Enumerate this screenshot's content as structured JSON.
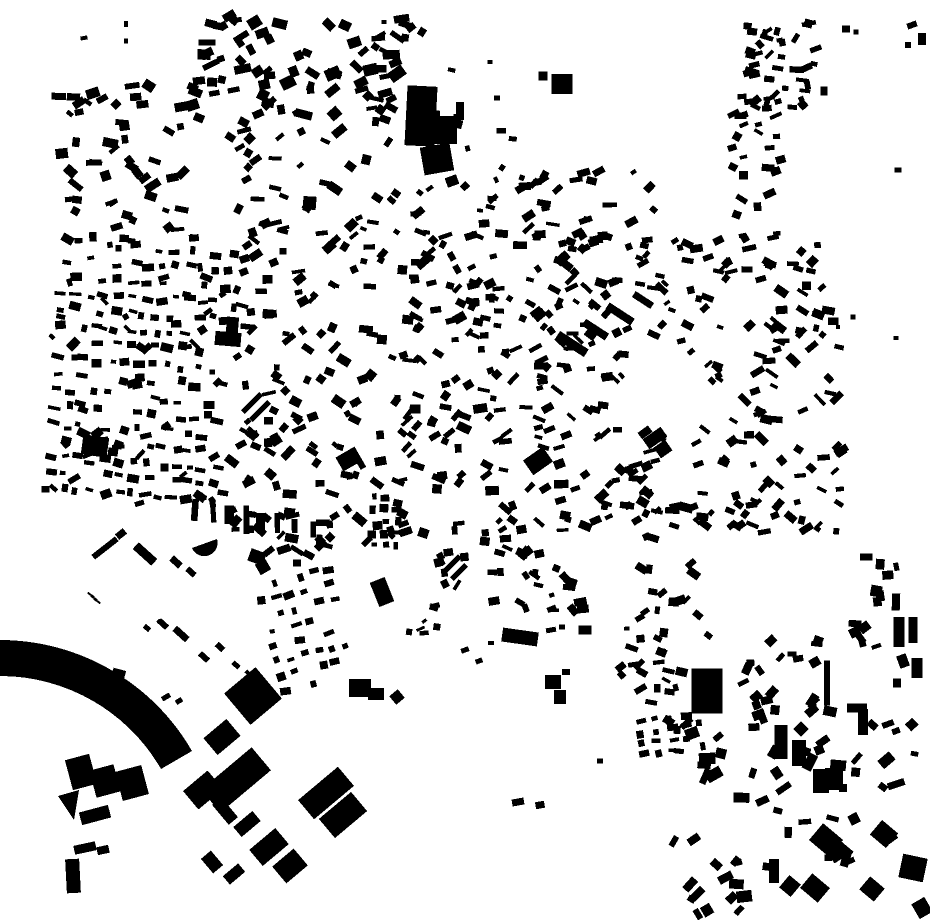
{
  "canvas": {
    "width": 930,
    "height": 924,
    "background": "#ffffff",
    "building_color": "#000000"
  },
  "map": {
    "kind": "figure-ground-building-footprints",
    "holes": [
      {
        "cx": 672,
        "cy": 392,
        "rx": 40,
        "ry": 45
      }
    ],
    "paths": [
      "M0,640 A222,222 0 0 1 192,751 L161,769 A186,186 0 0 0 0,676 Z",
      "M192,548 L217,539 A13.3,13.3 0 0 1 192,548 Z",
      "M58,796 L79,790 L74,820 Z"
    ],
    "landmark_rects": [
      [
        421,
        116,
        30,
        60,
        3
      ],
      [
        442,
        130,
        30,
        28,
        0
      ],
      [
        437,
        159,
        30,
        28,
        -10
      ],
      [
        460,
        111,
        8,
        18,
        0
      ],
      [
        452,
        181,
        12,
        10,
        -20
      ],
      [
        543,
        76,
        9,
        9,
        0
      ],
      [
        562,
        84,
        21,
        20,
        0
      ],
      [
        228,
        339,
        26,
        14,
        5
      ],
      [
        232,
        330,
        12,
        26,
        5
      ],
      [
        95,
        446,
        26,
        20,
        8
      ],
      [
        113,
        452,
        10,
        8,
        8
      ],
      [
        349,
        459,
        22,
        16,
        -30
      ],
      [
        538,
        461,
        24,
        18,
        -35
      ],
      [
        382,
        592,
        16,
        26,
        -22
      ],
      [
        252,
        403,
        26,
        5,
        -45
      ],
      [
        260,
        411,
        26,
        5,
        -45
      ],
      [
        452,
        564,
        22,
        5,
        -45
      ],
      [
        459,
        572,
        20,
        5,
        -45
      ],
      [
        572,
        344,
        34,
        9,
        33
      ],
      [
        596,
        330,
        26,
        8,
        33
      ],
      [
        620,
        314,
        30,
        8,
        33
      ],
      [
        643,
        300,
        22,
        7,
        33
      ],
      [
        655,
        438,
        22,
        12,
        -35
      ],
      [
        663,
        449,
        14,
        13,
        -35
      ],
      [
        520,
        637,
        36,
        14,
        8
      ],
      [
        553,
        682,
        16,
        14,
        0
      ],
      [
        560,
        697,
        12,
        14,
        0
      ],
      [
        566,
        672,
        8,
        6,
        0
      ],
      [
        585,
        630,
        13,
        9,
        0
      ],
      [
        551,
        630,
        10,
        5,
        -10
      ],
      [
        562,
        627,
        6,
        5,
        0
      ],
      [
        600,
        761,
        6,
        5,
        0
      ],
      [
        518,
        802,
        12,
        7,
        -10
      ],
      [
        540,
        805,
        9,
        7,
        -10
      ],
      [
        297,
        563,
        8,
        7,
        0
      ],
      [
        257,
        557,
        16,
        13,
        20
      ],
      [
        263,
        567,
        12,
        12,
        -30
      ],
      [
        707,
        691,
        31,
        45,
        0
      ],
      [
        821,
        781,
        16,
        24,
        0
      ],
      [
        834,
        779,
        18,
        22,
        0
      ],
      [
        843,
        788,
        8,
        8,
        0
      ],
      [
        857,
        708,
        20,
        9,
        0
      ],
      [
        863,
        722,
        10,
        26,
        0
      ],
      [
        888,
        724,
        12,
        6,
        -20
      ],
      [
        896,
        731,
        8,
        6,
        -20
      ],
      [
        781,
        742,
        13,
        34,
        0
      ],
      [
        799,
        753,
        14,
        26,
        0
      ],
      [
        801,
        729,
        11,
        11,
        45
      ],
      [
        827,
        683,
        6,
        45,
        0
      ],
      [
        884,
        834,
        21,
        19,
        40
      ],
      [
        826,
        840,
        26,
        22,
        40
      ],
      [
        843,
        852,
        16,
        14,
        40
      ],
      [
        913,
        868,
        25,
        24,
        12
      ],
      [
        922,
        908,
        15,
        17,
        -30
      ],
      [
        872,
        889,
        19,
        17,
        40
      ],
      [
        815,
        888,
        23,
        19,
        40
      ],
      [
        774,
        871,
        10,
        24,
        0
      ],
      [
        790,
        886,
        15,
        16,
        40
      ],
      [
        899,
        632,
        11,
        30,
        0
      ],
      [
        913,
        630,
        9,
        26,
        0
      ],
      [
        903,
        661,
        10,
        13,
        -20
      ],
      [
        917,
        668,
        11,
        20,
        0
      ],
      [
        897,
        683,
        8,
        9,
        0
      ],
      [
        81,
        772,
        25,
        31,
        -15
      ],
      [
        105,
        781,
        25,
        28,
        -15
      ],
      [
        132,
        783,
        27,
        30,
        -15
      ],
      [
        95,
        815,
        30,
        13,
        -15
      ],
      [
        85,
        848,
        22,
        9,
        -12
      ],
      [
        103,
        850,
        12,
        8,
        -12
      ],
      [
        73,
        876,
        14,
        34,
        -3
      ],
      [
        253,
        696,
        41,
        41,
        -40
      ],
      [
        222,
        737,
        30,
        22,
        -40
      ],
      [
        236,
        780,
        66,
        30,
        -40
      ],
      [
        203,
        790,
        32,
        24,
        -40
      ],
      [
        225,
        811,
        12,
        26,
        -40
      ],
      [
        247,
        824,
        25,
        13,
        -40
      ],
      [
        269,
        847,
        34,
        21,
        -40
      ],
      [
        290,
        866,
        28,
        22,
        -40
      ],
      [
        212,
        862,
        13,
        19,
        -40
      ],
      [
        234,
        874,
        20,
        11,
        -40
      ],
      [
        326,
        793,
        52,
        25,
        -40
      ],
      [
        343,
        815,
        42,
        25,
        -40
      ],
      [
        397,
        697,
        11,
        11,
        -40
      ],
      [
        360,
        688,
        22,
        18,
        0
      ],
      [
        376,
        694,
        16,
        12,
        0
      ],
      [
        117,
        680,
        13,
        22,
        15
      ],
      [
        166,
        697,
        9,
        5,
        -30
      ],
      [
        179,
        701,
        7,
        5,
        -30
      ],
      [
        147,
        628,
        7,
        5,
        40
      ],
      [
        160,
        622,
        6,
        4,
        40
      ],
      [
        163,
        624,
        11,
        6,
        42
      ],
      [
        181,
        634,
        17,
        7,
        42
      ],
      [
        204,
        657,
        11,
        6,
        42
      ],
      [
        220,
        647,
        9,
        6,
        42
      ],
      [
        236,
        665,
        8,
        5,
        42
      ],
      [
        248,
        673,
        6,
        4,
        42
      ],
      [
        105,
        548,
        30,
        6,
        -38
      ],
      [
        121,
        534,
        10,
        7,
        -38
      ],
      [
        145,
        554,
        25,
        9,
        42
      ],
      [
        176,
        562,
        12,
        7,
        42
      ],
      [
        191,
        572,
        10,
        6,
        42
      ],
      [
        91,
        595,
        8,
        2,
        35
      ],
      [
        94,
        598,
        8,
        2,
        35
      ],
      [
        97,
        601,
        8,
        2,
        35
      ],
      [
        84,
        38,
        7,
        4,
        -10
      ],
      [
        126,
        24,
        4,
        6,
        0
      ],
      [
        126,
        41,
        4,
        5,
        0
      ],
      [
        384,
        22,
        5,
        4,
        0
      ],
      [
        397,
        61,
        6,
        5,
        -20
      ],
      [
        490,
        62,
        5,
        4,
        0
      ],
      [
        497,
        98,
        6,
        5,
        0
      ],
      [
        912,
        25,
        10,
        6,
        -20
      ],
      [
        922,
        39,
        8,
        12,
        0
      ],
      [
        908,
        45,
        6,
        6,
        0
      ],
      [
        846,
        29,
        8,
        7,
        0
      ],
      [
        856,
        32,
        5,
        5,
        0
      ],
      [
        824,
        91,
        7,
        9,
        0
      ],
      [
        898,
        170,
        7,
        5,
        0
      ],
      [
        853,
        317,
        5,
        5,
        0
      ],
      [
        896,
        338,
        5,
        4,
        0
      ],
      [
        838,
        327,
        4,
        4,
        0
      ],
      [
        465,
        650,
        8,
        5,
        -20
      ],
      [
        479,
        661,
        7,
        5,
        -20
      ],
      [
        491,
        643,
        6,
        4,
        0
      ]
    ],
    "generators": [
      {
        "m": "s",
        "x": 130,
        "y": 162,
        "w": 150,
        "h": 155,
        "n": 55,
        "bw": 11,
        "bh": 7,
        "a": 0,
        "aj": 45,
        "s": 11
      },
      {
        "m": "s",
        "x": 300,
        "y": 70,
        "w": 215,
        "h": 112,
        "n": 72,
        "bw": 12,
        "bh": 8,
        "a": 0,
        "aj": 45,
        "s": 12
      },
      {
        "m": "s",
        "x": 292,
        "y": 180,
        "w": 125,
        "h": 105,
        "n": 30,
        "bw": 11,
        "bh": 7,
        "a": 0,
        "aj": 45,
        "s": 13
      },
      {
        "m": "s",
        "x": 398,
        "y": 112,
        "w": 130,
        "h": 175,
        "n": 26,
        "bw": 10,
        "bh": 7,
        "a": 0,
        "aj": 45,
        "s": 14
      },
      {
        "m": "g",
        "x": 140,
        "y": 372,
        "rows": 16,
        "cols": 13,
        "sx": 13.8,
        "sy": 16.5,
        "rot": 4,
        "bw": 9,
        "bh": 6,
        "aj": 14,
        "skip": 0.28,
        "jit": 3.5,
        "s": 15
      },
      {
        "m": "s",
        "x": 140,
        "y": 372,
        "w": 180,
        "h": 265,
        "n": 45,
        "bw": 9,
        "bh": 6,
        "a": 0,
        "aj": 50,
        "s": 16
      },
      {
        "m": "s",
        "x": 398,
        "y": 390,
        "w": 335,
        "h": 330,
        "n": 300,
        "bw": 10,
        "bh": 6.5,
        "a": -5,
        "aj": 50,
        "s": 17
      },
      {
        "m": "s",
        "x": 700,
        "y": 388,
        "w": 285,
        "h": 300,
        "n": 250,
        "bw": 10,
        "bh": 6,
        "a": 0,
        "aj": 50,
        "s": 18
      },
      {
        "m": "s",
        "x": 782,
        "y": 66,
        "w": 72,
        "h": 85,
        "n": 40,
        "bw": 10,
        "bh": 6,
        "a": -20,
        "aj": 40,
        "s": 19
      },
      {
        "m": "s",
        "x": 757,
        "y": 165,
        "w": 50,
        "h": 150,
        "n": 30,
        "bw": 9,
        "bh": 6,
        "a": 0,
        "aj": 35,
        "s": 20
      },
      {
        "m": "s",
        "x": 560,
        "y": 213,
        "w": 215,
        "h": 88,
        "n": 46,
        "bw": 10,
        "bh": 6,
        "a": -10,
        "aj": 40,
        "s": 21
      },
      {
        "m": "r",
        "x1": 196,
        "y1": 511,
        "x2": 312,
        "y2": 529,
        "n": 8,
        "bw": 9,
        "bh": 25,
        "a": 0,
        "skip": 0,
        "jit": 2,
        "s": 22
      },
      {
        "m": "g",
        "x": 306,
        "y": 630,
        "rows": 8,
        "cols": 6,
        "sx": 14,
        "sy": 15.5,
        "rot": -14,
        "bw": 8,
        "bh": 6,
        "aj": 8,
        "skip": 0.16,
        "jit": 2,
        "s": 23
      },
      {
        "m": "g",
        "x": 385,
        "y": 521,
        "rows": 5,
        "cols": 3,
        "sx": 12,
        "sy": 12,
        "rot": 0,
        "bw": 7,
        "bh": 6,
        "aj": 6,
        "skip": 0.1,
        "jit": 1.5,
        "s": 24
      },
      {
        "m": "g",
        "x": 672,
        "y": 734,
        "rows": 4,
        "cols": 5,
        "sx": 15,
        "sy": 11.5,
        "rot": -8,
        "bw": 8,
        "bh": 6,
        "aj": 8,
        "skip": 0.15,
        "jit": 2,
        "s": 25
      },
      {
        "m": "s",
        "x": 665,
        "y": 640,
        "w": 95,
        "h": 165,
        "n": 32,
        "bw": 9,
        "bh": 6,
        "a": 0,
        "aj": 45,
        "s": 26
      },
      {
        "m": "r",
        "x1": 652,
        "y1": 572,
        "x2": 680,
        "y2": 752,
        "n": 10,
        "bw": 9,
        "bh": 7,
        "a": 10,
        "skip": 0.1,
        "jit": 3,
        "s": 27
      },
      {
        "m": "s",
        "x": 778,
        "y": 676,
        "w": 85,
        "h": 80,
        "n": 20,
        "bw": 10,
        "bh": 7,
        "a": -30,
        "aj": 40,
        "s": 28
      },
      {
        "m": "s",
        "x": 792,
        "y": 798,
        "w": 255,
        "h": 175,
        "n": 48,
        "bw": 12,
        "bh": 8,
        "a": -30,
        "aj": 45,
        "s": 29
      },
      {
        "m": "s",
        "x": 712,
        "y": 888,
        "w": 75,
        "h": 60,
        "n": 10,
        "bw": 11,
        "bh": 8,
        "a": -20,
        "aj": 40,
        "s": 30
      },
      {
        "m": "s",
        "x": 537,
        "y": 585,
        "w": 95,
        "h": 75,
        "n": 22,
        "bw": 9,
        "bh": 6,
        "a": 10,
        "aj": 45,
        "s": 31
      },
      {
        "m": "s",
        "x": 450,
        "y": 572,
        "w": 45,
        "h": 40,
        "n": 8,
        "bw": 9,
        "bh": 6,
        "a": -30,
        "aj": 30,
        "s": 32
      },
      {
        "m": "s",
        "x": 418,
        "y": 618,
        "w": 50,
        "h": 45,
        "n": 7,
        "bw": 8,
        "bh": 5,
        "a": -20,
        "aj": 40,
        "s": 33
      },
      {
        "m": "s",
        "x": 877,
        "y": 578,
        "w": 40,
        "h": 55,
        "n": 8,
        "bw": 9,
        "bh": 12,
        "a": 0,
        "aj": 12,
        "s": 34
      },
      {
        "m": "s",
        "x": 872,
        "y": 632,
        "w": 35,
        "h": 40,
        "n": 6,
        "bw": 9,
        "bh": 7,
        "a": -20,
        "aj": 30,
        "s": 35
      },
      {
        "m": "s",
        "x": 390,
        "y": 208,
        "w": 80,
        "h": 55,
        "n": 10,
        "bw": 9,
        "bh": 6,
        "a": -15,
        "aj": 40,
        "s": 36
      },
      {
        "m": "s",
        "x": 495,
        "y": 150,
        "w": 70,
        "h": 60,
        "n": 6,
        "bw": 7,
        "bh": 5,
        "a": 0,
        "aj": 40,
        "s": 37
      }
    ]
  }
}
